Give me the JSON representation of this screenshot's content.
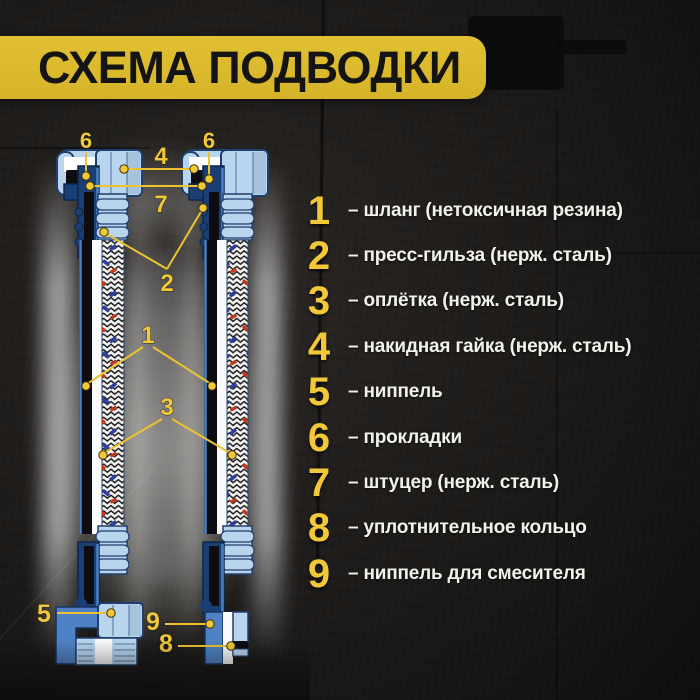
{
  "title": "СХЕМА ПОДВОДКИ",
  "legend": {
    "items": [
      {
        "num": "1",
        "text": "– шланг (нетоксичная резина)"
      },
      {
        "num": "2",
        "text": "– пресс-гильза (нерж. сталь)"
      },
      {
        "num": "3",
        "text": "– оплётка (нерж. сталь)"
      },
      {
        "num": "4",
        "text": "– накидная гайка (нерж. сталь)"
      },
      {
        "num": "5",
        "text": "– ниппель"
      },
      {
        "num": "6",
        "text": "– прокладки"
      },
      {
        "num": "7",
        "text": "– штуцер (нерж. сталь)"
      },
      {
        "num": "8",
        "text": "– уплотнительное кольцо"
      },
      {
        "num": "9",
        "text": "– ниппель для смесителя"
      }
    ]
  },
  "diagram": {
    "callouts": {
      "hose": "1",
      "press_sleeve": "2",
      "braid": "3",
      "cap_nut": "4",
      "nipple": "5",
      "gasket_left": "6",
      "gasket_right": "6",
      "fitting": "7",
      "oring": "8",
      "mixer_nipple": "9"
    }
  },
  "colors": {
    "banner_yellow": "#d9b82c",
    "accent_yellow": "#f2c838",
    "light_blue": "#b9d5ee",
    "navy": "#1a3f74",
    "bright_blue": "#4a80c6",
    "braid_red": "#c23a1c",
    "braid_blue": "#2e3da0"
  }
}
